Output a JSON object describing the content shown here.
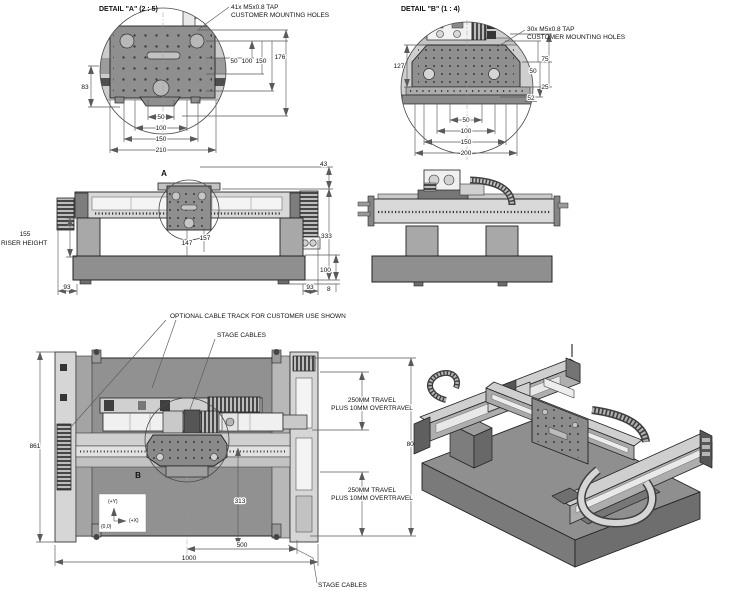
{
  "sheet": {
    "type": "engineering-drawing",
    "background": "#ffffff"
  },
  "palette": {
    "line": "#2e2e2e",
    "dim_line": "#5a5a5a",
    "plate_gray": "#8f8f8f",
    "slab_gray": "#919191",
    "light_gray": "#d9d9d9",
    "mid_gray": "#b2b2b2",
    "dark_gray": "#6e6e6e",
    "white": "#f5f5f5"
  },
  "detail_a": {
    "title": "DETAIL \"A\" (2 : 5)",
    "callout1": "41x M5x0.8 TAP",
    "callout2": "CUSTOMER MOUNTING HOLES",
    "dim_50": "50",
    "dim_100": "100",
    "dim_150": "150",
    "dim_176": "176",
    "dim_83": "83",
    "dim_b50": "50",
    "dim_b100": "100",
    "dim_b150": "150",
    "dim_b210": "210"
  },
  "detail_b": {
    "title": "DETAIL \"B\" (1 : 4)",
    "callout1": "30x M5x0.8 TAP",
    "callout2": "CUSTOMER MOUNTING HOLES",
    "dim_127": "127",
    "dim_75": "75",
    "dim_50": "50",
    "dim_25": "25",
    "dim_52": "52",
    "dim_b50": "50",
    "dim_b100": "100",
    "dim_b150": "150",
    "dim_b200": "200"
  },
  "front_view": {
    "marker": "A",
    "dim_43": "43",
    "dim_333": "333",
    "dim_100": "100",
    "dim_8": "8",
    "dim_147": "147",
    "dim_157": "157",
    "dim_93_left": "93",
    "dim_93_right": "93",
    "riser_height_value": "155",
    "riser_height_label": "RISER HEIGHT"
  },
  "plan_view": {
    "marker": "B",
    "note_optional_track": "OPTIONAL CABLE TRACK FOR CUSTOMER USE SHOWN",
    "note_stage_cables_top": "STAGE CABLES",
    "note_stage_cables_bottom": "STAGE CABLES",
    "travel1_line1": "250MM TRAVEL",
    "travel1_line2": "PLUS 10MM OVERTRAVEL",
    "travel2_line1": "250MM TRAVEL",
    "travel2_line2": "PLUS 10MM OVERTRAVEL",
    "dim_861": "861",
    "dim_800": "800",
    "dim_313": "313",
    "dim_500": "500",
    "dim_1000": "1000",
    "axis_plus_y": "(+Y)",
    "axis_plus_x": "(+X)",
    "axis_origin": "(0,0)"
  }
}
